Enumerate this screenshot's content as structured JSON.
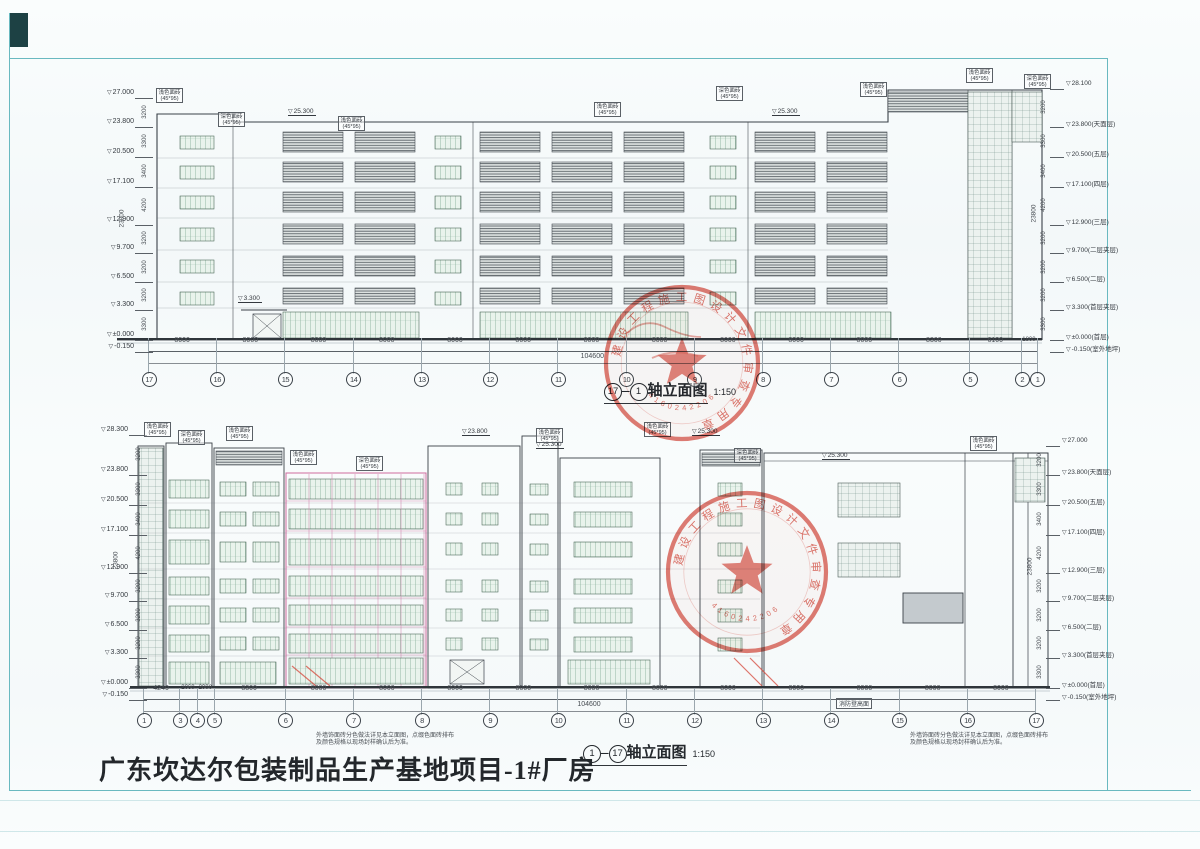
{
  "page": {
    "project_title": "广东坎达尔包装制品生产基地项目-1#厂房",
    "note_line1": "外墙饰面砖分色做法详见本立面图，点缀色面砖排布",
    "note_line2": "及颜色规格以现场封样确认后为准。",
    "ground_label": "消防登高面"
  },
  "materials": {
    "light": "浅色面砖",
    "dark": "深色面砖",
    "size": "(45*95)"
  },
  "stamp": {
    "ring": "建设工程施工图设计文件审查专用章",
    "number": "4160242206"
  },
  "drawings": {
    "top": {
      "axis_from": "17",
      "axis_to": "1",
      "title_text": "轴立面图",
      "scale": "1:150",
      "axes": [
        "17",
        "16",
        "15",
        "14",
        "13",
        "12",
        "11",
        "10",
        "9",
        "8",
        "7",
        "6",
        "5",
        "2",
        "1"
      ],
      "spacings_mm": [
        8000,
        8000,
        8000,
        8000,
        8000,
        8000,
        8000,
        8000,
        8000,
        8000,
        8000,
        8300,
        6100,
        1800
      ],
      "total": "104600",
      "total_height": "23800",
      "height_dims": [
        "3200",
        "3300",
        "3400",
        "4200",
        "3200",
        "3200",
        "3200",
        "3300"
      ],
      "left_levels": [
        {
          "v": "27.000",
          "e": 27
        },
        {
          "v": "23.800",
          "e": 23.8
        },
        {
          "v": "20.500",
          "e": 20.5
        },
        {
          "v": "17.100",
          "e": 17.1
        },
        {
          "v": "12.900",
          "e": 12.9
        },
        {
          "v": "9.700",
          "e": 9.7
        },
        {
          "v": "6.500",
          "e": 6.5
        },
        {
          "v": "3.300",
          "e": 3.3
        },
        {
          "v": "±0.000",
          "e": 0
        },
        {
          "v": "-0.150",
          "e": -0.15
        }
      ],
      "right_levels": [
        {
          "v": "28.100",
          "e": 28.1
        },
        {
          "v": "23.800(天面层)",
          "e": 23.8
        },
        {
          "v": "20.500(五层)",
          "e": 20.5
        },
        {
          "v": "17.100(四层)",
          "e": 17.1
        },
        {
          "v": "12.900(三层)",
          "e": 12.9
        },
        {
          "v": "9.700(二层夹层)",
          "e": 9.7
        },
        {
          "v": "6.500(二层)",
          "e": 6.5
        },
        {
          "v": "3.300(首层夹层)",
          "e": 3.3
        },
        {
          "v": "±0.000(首层)",
          "e": 0
        },
        {
          "v": "-0.150(室外地坪)",
          "e": -0.15
        }
      ],
      "marks": [
        {
          "v": "25.300",
          "x": 288,
          "y": 108
        },
        {
          "v": "25.300",
          "x": 772,
          "y": 108
        },
        {
          "v": "3.300",
          "x": 238,
          "y": 295
        }
      ]
    },
    "bottom": {
      "axis_from": "1",
      "axis_to": "17",
      "title_text": "轴立面图",
      "scale": "1:150",
      "axes": [
        "1",
        "3",
        "4",
        "5",
        "6",
        "7",
        "8",
        "9",
        "10",
        "11",
        "12",
        "13",
        "14",
        "15",
        "16",
        "17"
      ],
      "spacings_mm": [
        4240,
        2060,
        2000,
        8300,
        8000,
        8000,
        8000,
        8000,
        8000,
        8000,
        8000,
        8000,
        8000,
        8000,
        8000
      ],
      "total": "104600",
      "total_height": "23800",
      "height_dims": [
        "3200",
        "3300",
        "3400",
        "4200",
        "3200",
        "3200",
        "3200",
        "3300"
      ],
      "left_levels": [
        {
          "v": "28.300",
          "e": 28.3
        },
        {
          "v": "23.800",
          "e": 23.8
        },
        {
          "v": "20.500",
          "e": 20.5
        },
        {
          "v": "17.100",
          "e": 17.1
        },
        {
          "v": "12.900",
          "e": 12.9
        },
        {
          "v": "9.700",
          "e": 9.7
        },
        {
          "v": "6.500",
          "e": 6.5
        },
        {
          "v": "3.300",
          "e": 3.3
        },
        {
          "v": "±0.000",
          "e": 0
        },
        {
          "v": "-0.150",
          "e": -0.15
        }
      ],
      "right_levels": [
        {
          "v": "27.000",
          "e": 27
        },
        {
          "v": "23.800(天面层)",
          "e": 23.8
        },
        {
          "v": "20.500(五层)",
          "e": 20.5
        },
        {
          "v": "17.100(四层)",
          "e": 17.1
        },
        {
          "v": "12.900(三层)",
          "e": 12.9
        },
        {
          "v": "9.700(二层夹层)",
          "e": 9.7
        },
        {
          "v": "6.500(二层)",
          "e": 6.5
        },
        {
          "v": "3.300(首层夹层)",
          "e": 3.3
        },
        {
          "v": "±0.000(首层)",
          "e": 0
        },
        {
          "v": "-0.150(室外地坪)",
          "e": -0.15
        }
      ],
      "marks": [
        {
          "v": "23.800",
          "x": 462,
          "y": 428
        },
        {
          "v": "25.300",
          "x": 536,
          "y": 441
        },
        {
          "v": "25.300",
          "x": 692,
          "y": 428
        },
        {
          "v": "25.300",
          "x": 822,
          "y": 452
        }
      ]
    }
  }
}
